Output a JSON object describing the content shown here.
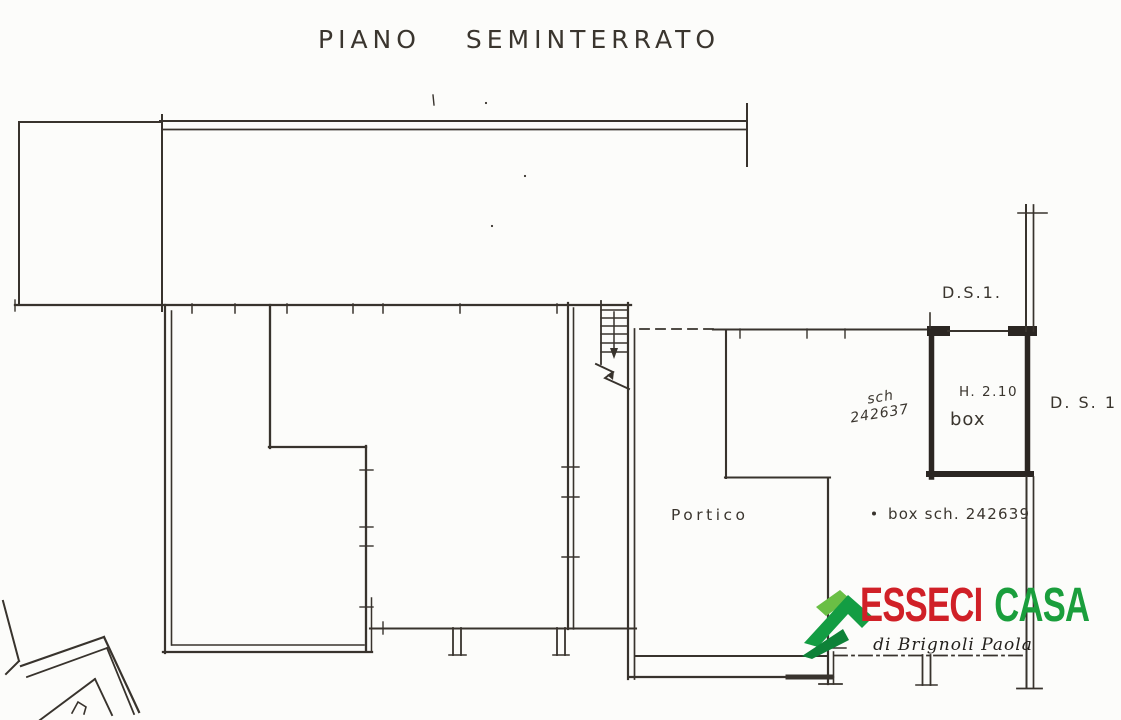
{
  "page": {
    "background": "#fcfcfa",
    "ink": "#38332d"
  },
  "title": "PIANO SEMINTERRATO",
  "plan_labels": {
    "ds1_top": "D.S.1.",
    "ds1_right": "D. S. 1 .",
    "stair_ref": {
      "line1": "sch",
      "line2": "242637"
    },
    "box_height": "H. 2.10",
    "box_room": "box",
    "portico": "Portico",
    "box_reference": "box sch. 242639"
  },
  "logo": {
    "brand_primary": "ESSECI",
    "brand_secondary": "CASA",
    "tagline": "di Brignoli Paola",
    "colors": {
      "primary_red": "#d02027",
      "brand_green": "#1a9e3c",
      "roof_light_green": "#6abf45",
      "roof_dark_green": "#0e8238"
    }
  }
}
